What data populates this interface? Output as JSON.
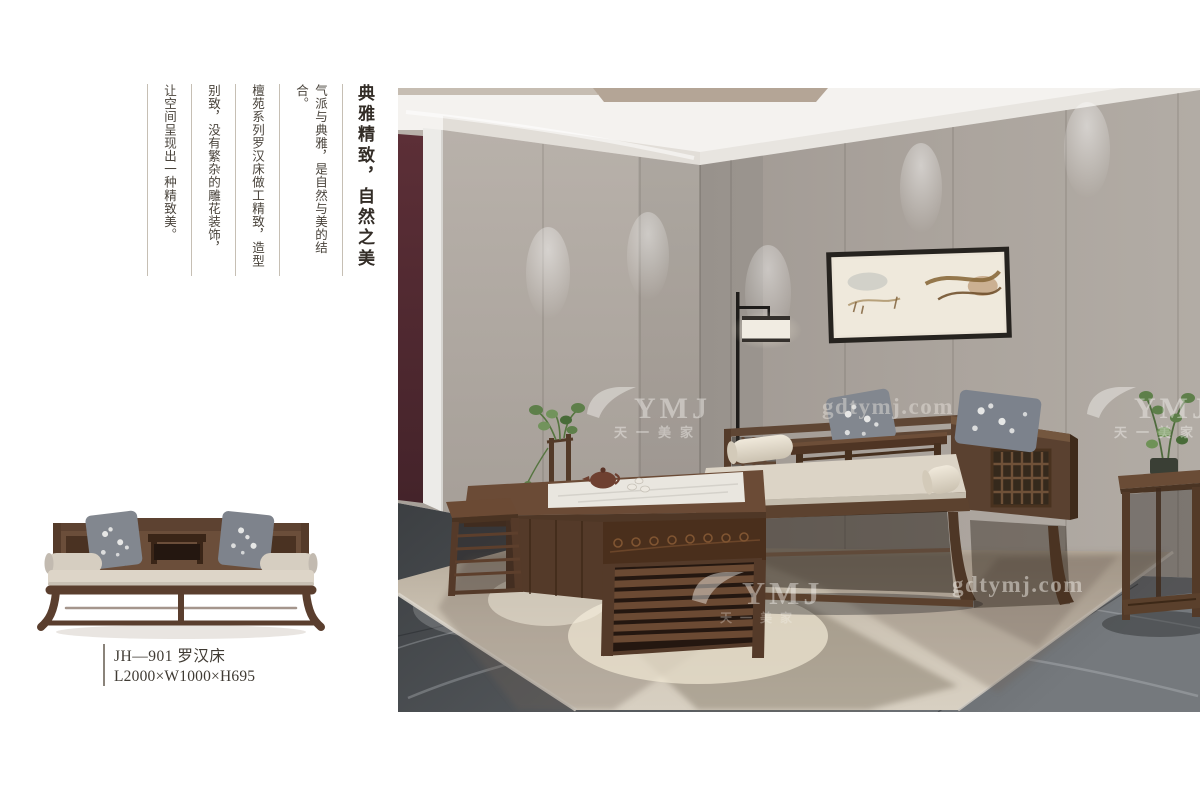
{
  "intro": {
    "title": "典雅精致，自然之美",
    "columns": [
      "气派与典雅，是自然与美的结合。",
      "檀苑系列罗汉床做工精致，造型",
      "别致，没有繁杂的雕花装饰，",
      "让空间呈现出一种精致美。"
    ]
  },
  "product": {
    "model": "JH—901 罗汉床",
    "dimensions": "L2000×W1000×H695"
  },
  "watermarks": {
    "brand": "YMJ",
    "brand_cn": "天一美家",
    "domain": "gdtymj.com"
  },
  "colors": {
    "wood": "#5d4231",
    "wall": "#a9a29b",
    "accent_wall": "#512a31",
    "floor": "#4a4d50",
    "rug": "#c9c0b1"
  }
}
